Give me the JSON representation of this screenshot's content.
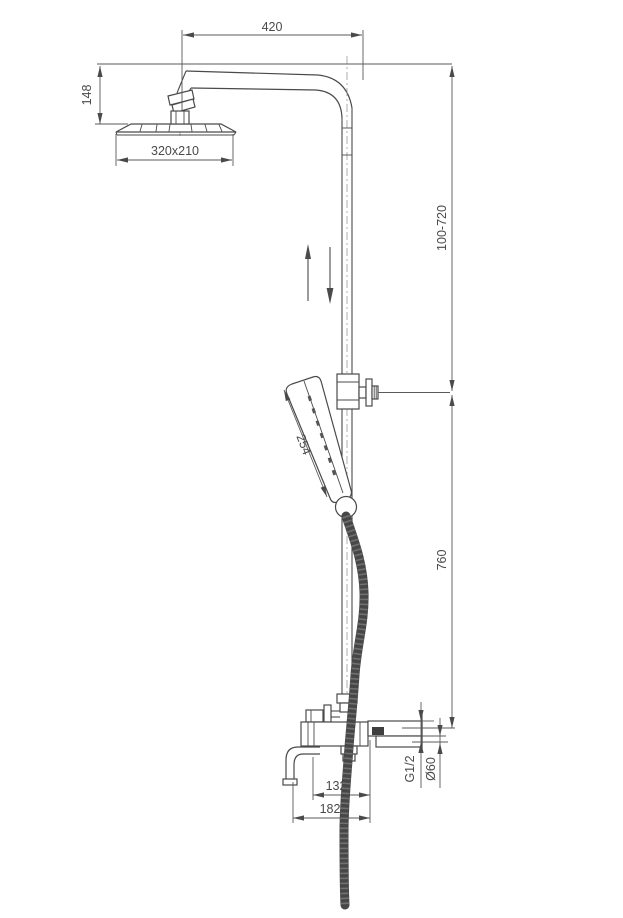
{
  "dims": {
    "arm_reach": "420",
    "head_offset": "148",
    "head_size": "320x210",
    "adjustable_height": "100-720",
    "hand_shower_length": "254",
    "lower_height": "760",
    "spout_inner": "132",
    "spout_reach": "182",
    "thread_size": "G1/2",
    "escutcheon_diameter": "Ø60"
  },
  "colors": {
    "line": "#4a4a4a",
    "hose": "#474747",
    "background": "#ffffff"
  }
}
